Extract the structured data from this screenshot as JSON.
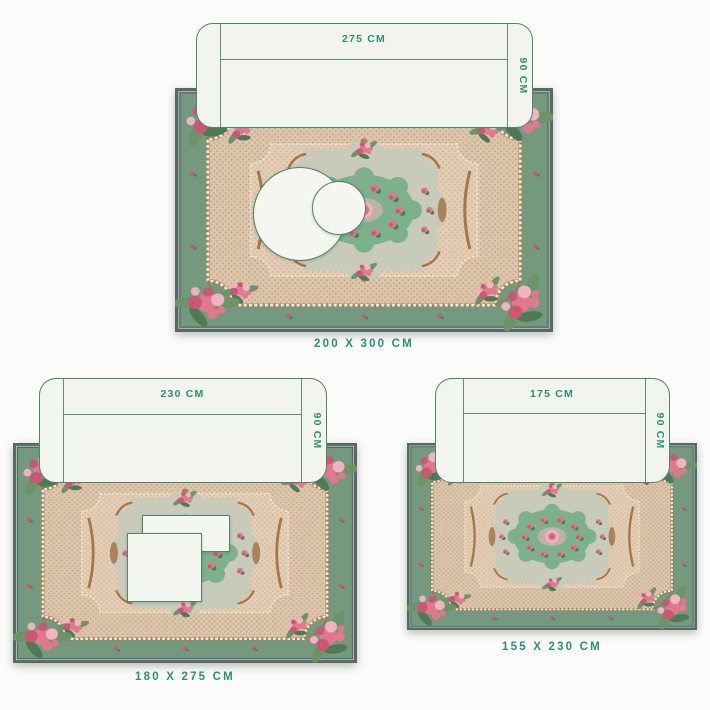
{
  "colors": {
    "background": "#fbfbfa",
    "accent_text": "#2c8f75",
    "sofa_fill": "#f2f5ee",
    "sofa_stroke": "#53806f",
    "table_fill": "#f4f6f0",
    "rug_frame": "#556965",
    "rug_frame_line": "#b9c4b4",
    "rug_band": "#74997f",
    "rug_field": "#dcc5ab",
    "rug_field_dot": "#c2a583",
    "rug_field2": "#e3cdb4",
    "rug_field_dot2": "#cfb497",
    "rug_pearl": "#f0ead9",
    "rug_chain_base": "#a5764b",
    "rug_cartouche": "#c8cbba",
    "rug_medallion": "#7cb18c",
    "rose": "#e0798f",
    "rose_deep": "#c95876",
    "rose_light": "#f0b3c0",
    "leaf": "#6d9468",
    "leaf_dark": "#4e7a55",
    "flourish_brown": "#a5764b"
  },
  "diagrams": [
    {
      "sofa_width": "275 CM",
      "sofa_depth": "90 CM",
      "size_label": "200 X 300 CM"
    },
    {
      "sofa_width": "230 CM",
      "sofa_depth": "90 CM",
      "size_label": "180 X 275 CM"
    },
    {
      "sofa_width": "175 CM",
      "sofa_depth": "90 CM",
      "size_label": "155 X 230 CM"
    }
  ]
}
